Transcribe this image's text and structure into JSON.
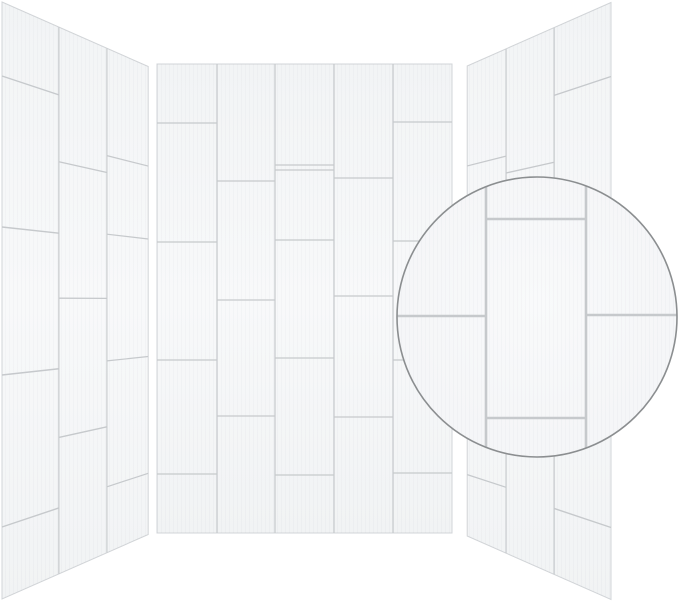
{
  "product": {
    "description": "three-wall shower surround with white vertical subway tile panels and magnified tile detail inset",
    "background": "#ffffff"
  },
  "colors": {
    "background": "#ffffff",
    "tile_top": "#f2f4f5",
    "tile_mid": "#f8f9fa",
    "tile_bottom": "#f1f3f4",
    "panel_edge": "#d2d5d8",
    "grout": "#c6c9cc",
    "streak": "rgba(100,110,120,0.03)",
    "inset_ring": "#8b8e90",
    "inset_fill_center": "#f9fafb",
    "inset_fill_edge": "#f3f4f6"
  },
  "projection": {
    "perspective": 1200,
    "angle_deg": 60.6
  },
  "panels": [
    {
      "id": "left-wall-panel",
      "type": "perspective",
      "near_x": 2,
      "cy": 300.5,
      "dir": 1,
      "texture_w": 380,
      "texture_h": 597,
      "column_edges_u": [
        0,
        126.5,
        253,
        380
      ],
      "column_grouts_v": [
        [
          74,
          225,
          373,
          525
        ],
        [
          147,
          296,
          448
        ],
        [
          127,
          220,
          370,
          519
        ]
      ]
    },
    {
      "id": "back-wall-panel",
      "type": "flat",
      "x": 157,
      "y": 64,
      "w": 295,
      "h": 469,
      "column_edges": [
        0,
        60,
        118,
        177,
        236,
        295
      ],
      "column_grouts": [
        [
          59,
          178,
          296,
          410
        ],
        [
          117,
          236,
          352
        ],
        [
          101,
          106,
          176,
          294,
          411
        ],
        [
          114,
          232,
          353
        ],
        [
          58,
          177,
          296,
          409
        ]
      ]
    },
    {
      "id": "right-wall-panel",
      "type": "perspective",
      "near_x": 611,
      "cy": 301,
      "dir": -1,
      "texture_w": 372,
      "texture_h": 597,
      "column_edges_u": [
        0,
        126.5,
        253,
        372
      ],
      "column_grouts_v": [
        [
          74,
          225,
          373,
          525
        ],
        [
          147,
          296,
          448
        ],
        [
          127,
          220,
          370,
          519
        ]
      ]
    }
  ],
  "inset": {
    "cx": 537,
    "cy": 317,
    "r": 140,
    "ring_width": 1.6,
    "grout_width": 2.6,
    "vertical_lines_x": [
      486,
      586
    ],
    "horizontal_lines": [
      {
        "y": 316,
        "x0": 392,
        "x1": 486
      },
      {
        "y": 315,
        "x0": 586,
        "x1": 682
      },
      {
        "y": 219,
        "x0": 486,
        "x1": 586
      },
      {
        "y": 418,
        "x0": 486,
        "x1": 586
      }
    ]
  },
  "line_widths": {
    "flat_grout": 1.3,
    "flat_column": 1.2,
    "persp_grout": 1.5,
    "persp_column": 1.3,
    "panel_edge": 1.0
  }
}
